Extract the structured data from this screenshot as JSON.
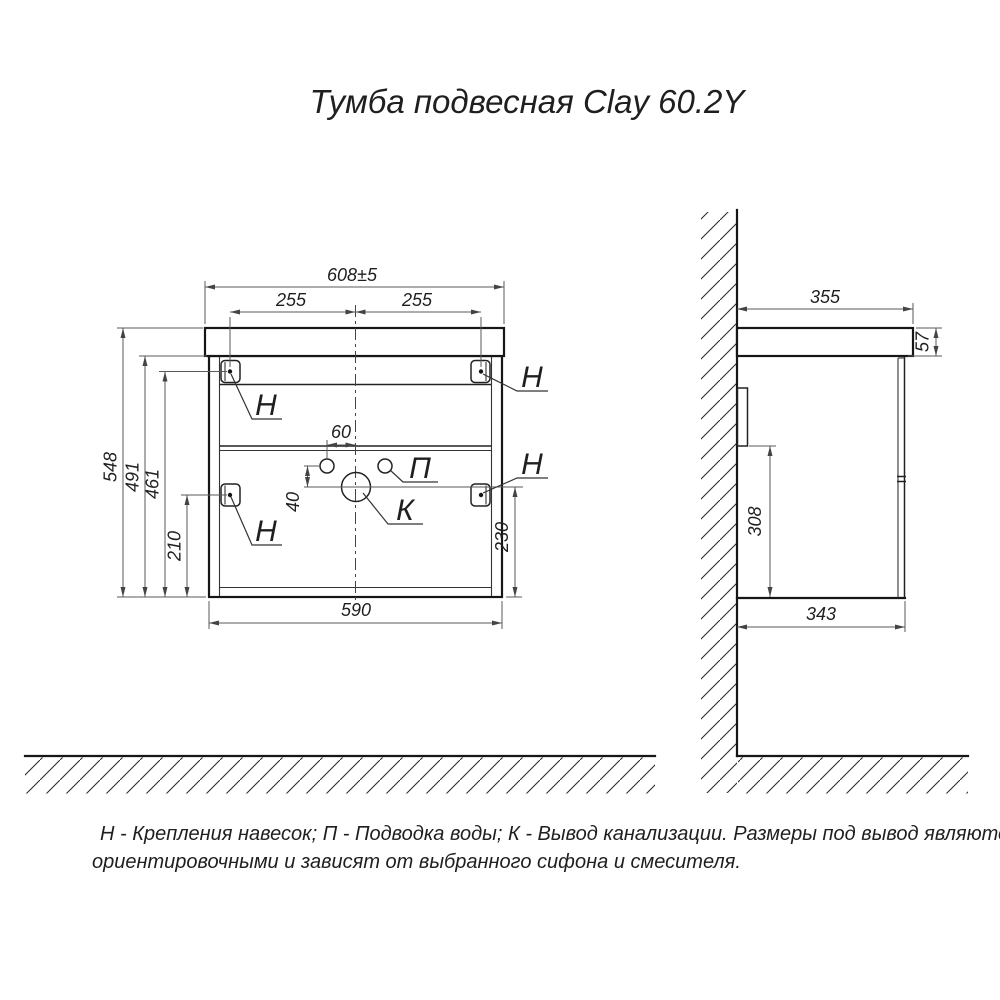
{
  "title": "Тумба подвесная Clay 60.2Y",
  "note": {
    "line1": "Н - Крепления навесок; П - Подводка воды; К - Вывод канализации. Размеры под вывод являются",
    "line2": "ориентировочными и зависят от выбранного сифона и смесителя."
  },
  "front_view": {
    "dim_width_top": "608±5",
    "dim_hanger_left": "255",
    "dim_hanger_right": "255",
    "dim_height_total": "548",
    "dim_height_carcass": "491",
    "dim_hanger_top": "461",
    "dim_hanger_mid": "210",
    "dim_water_offset": "60",
    "dim_drain_drop": "40",
    "dim_drain_height": "230",
    "dim_width_carcass": "590",
    "label_hanger_top_left": "Н",
    "label_hanger_top_right": "Н",
    "label_hanger_mid_left": "Н",
    "label_hanger_mid_right": "Н",
    "label_water_supply": "П",
    "label_drain": "К"
  },
  "side_view": {
    "dim_depth_top": "355",
    "dim_top_thickness": "57",
    "dim_hanger_drop": "308",
    "dim_depth_carcass": "343"
  }
}
